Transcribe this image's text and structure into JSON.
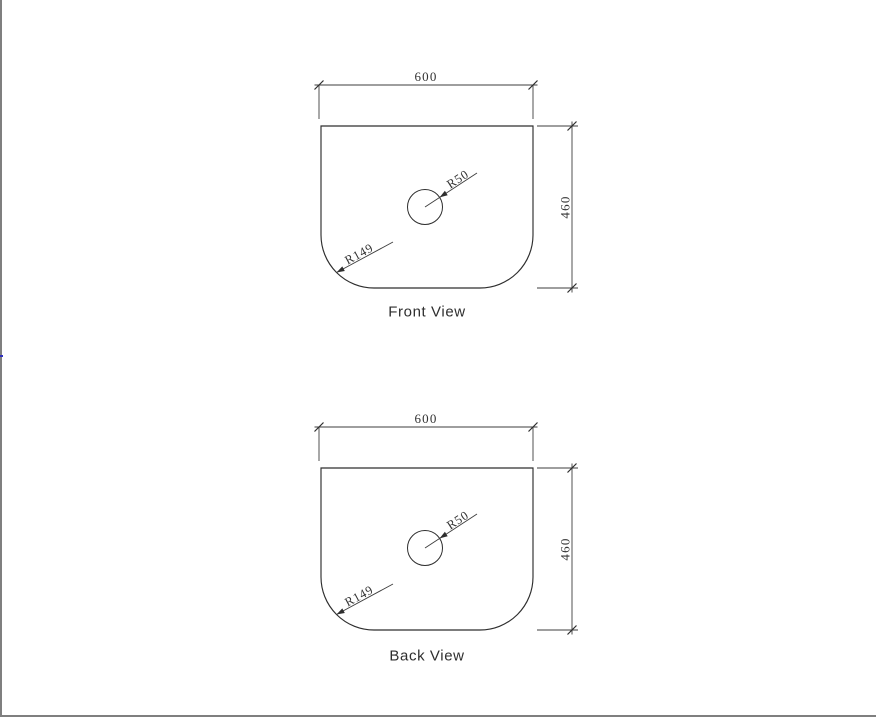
{
  "page": {
    "background_color": "#ffffff",
    "edge_line_color": "#7f7f7f",
    "edge_accent_color": "#2f2fbf"
  },
  "drawing": {
    "outline_color": "#2e2e2e",
    "dimension_color": "#3d3d3d",
    "text_color": "#333333"
  },
  "views": [
    {
      "id": "front",
      "title": "Front View",
      "width_label": "600",
      "height_label": "460",
      "hole_radius_label": "R50",
      "corner_radius_label": "R149"
    },
    {
      "id": "back",
      "title": "Back View",
      "width_label": "600",
      "height_label": "460",
      "hole_radius_label": "R50",
      "corner_radius_label": "R149"
    }
  ]
}
